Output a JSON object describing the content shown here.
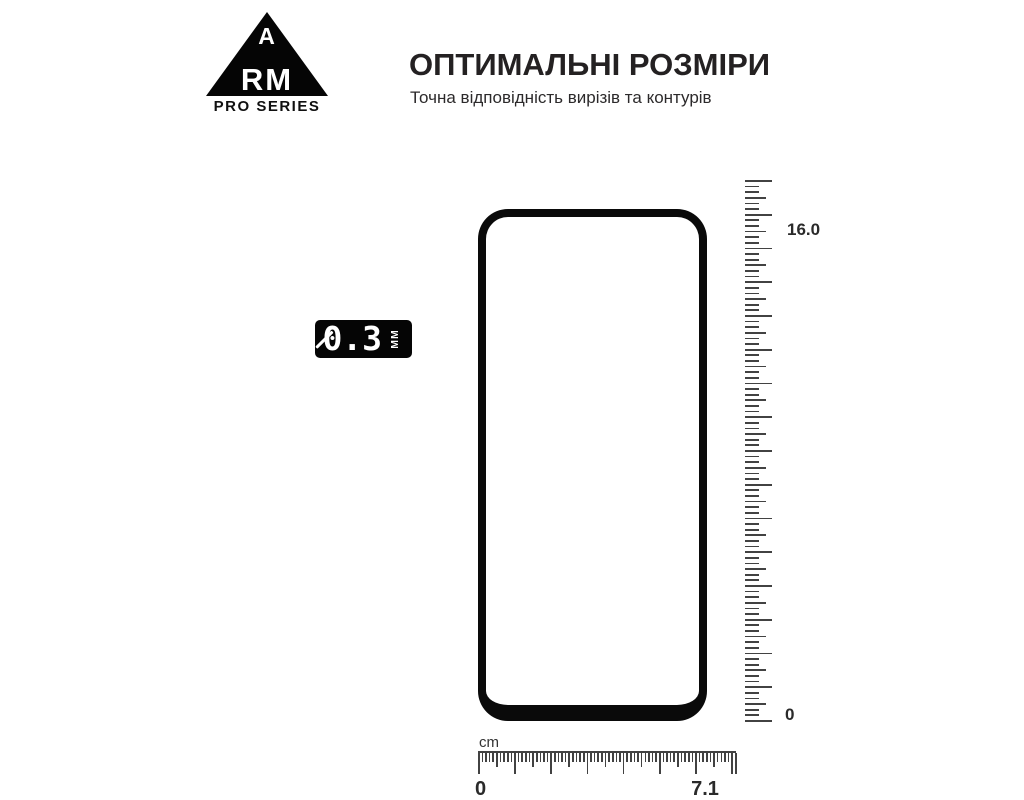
{
  "brand": {
    "letter_a": "A",
    "letters_rm": "RM",
    "series_label": "PRO SERIES"
  },
  "header": {
    "title": "ОПТИМАЛЬНІ РОЗМІРИ",
    "subtitle": "Точна відповідність вирізів та контурів"
  },
  "thickness_badge": {
    "value": "0.3",
    "unit": "ММ"
  },
  "vertical_ruler": {
    "top_label": "16.0",
    "bottom_label": "0",
    "length_cm": 16,
    "subdivisions_per_cm": 6
  },
  "horizontal_ruler": {
    "unit_label": "cm",
    "left_label": "0",
    "right_label": "7.1",
    "length_mm": 71
  },
  "colors": {
    "background": "#ffffff",
    "text_dark": "#242122",
    "ruler_tick": "#424242",
    "phone_outline": "#0a0a0a",
    "badge_background": "#050505",
    "badge_text": "#ffffff"
  }
}
